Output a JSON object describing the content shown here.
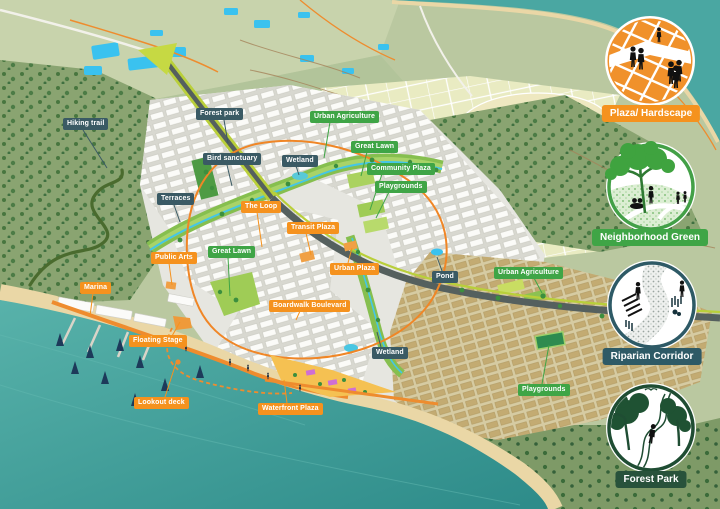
{
  "map_labels": [
    {
      "text": "Hiking trail",
      "category": "nature"
    },
    {
      "text": "Forest park",
      "category": "nature"
    },
    {
      "text": "Bird sanctuary",
      "category": "nature"
    },
    {
      "text": "Terraces",
      "category": "nature"
    },
    {
      "text": "The Loop",
      "category": "urban"
    },
    {
      "text": "Urban Agriculture",
      "category": "green"
    },
    {
      "text": "Great Lawn",
      "category": "green"
    },
    {
      "text": "Wetland",
      "category": "nature"
    },
    {
      "text": "Community Plaza",
      "category": "green"
    },
    {
      "text": "Playgrounds",
      "category": "green"
    },
    {
      "text": "Transit Plaza",
      "category": "urban"
    },
    {
      "text": "Urban Plaza",
      "category": "urban"
    },
    {
      "text": "Great Lawn",
      "category": "green"
    },
    {
      "text": "Public Arts",
      "category": "urban"
    },
    {
      "text": "Marina",
      "category": "urban"
    },
    {
      "text": "Boardwalk Boulevard",
      "category": "urban"
    },
    {
      "text": "Floating Stage",
      "category": "urban"
    },
    {
      "text": "Lookout deck",
      "category": "urban"
    },
    {
      "text": "Waterfront Plaza",
      "category": "urban"
    },
    {
      "text": "Wetland",
      "category": "nature"
    },
    {
      "text": "Pond",
      "category": "nature"
    },
    {
      "text": "Urban Agriculture",
      "category": "green"
    },
    {
      "text": "Playgrounds",
      "category": "green"
    }
  ],
  "legend": {
    "items": [
      {
        "label": "Plaza/ Hardscape",
        "color": "#f5921e",
        "icon": "plaza-hardscape-icon"
      },
      {
        "label": "Neighborhood Green",
        "color": "#3fa546",
        "icon": "neighborhood-green-icon"
      },
      {
        "label": "Riparian Corridor",
        "color": "#2e5a66",
        "icon": "riparian-corridor-icon"
      },
      {
        "label": "Forest Park",
        "color": "#28523b",
        "icon": "forest-park-icon"
      }
    ]
  },
  "tag_colors": {
    "green": "#3fa546",
    "orange": "#f5921e",
    "dark": "#3a5a64"
  },
  "map_colors": {
    "sea": "#3f9e9a",
    "sand": "#ead7a6",
    "hills": "#8aa471",
    "fields": "#e9ebc2",
    "city": "#e6e6e0",
    "axis": "#b9cf3a",
    "loop": "#f08626",
    "stream": "#45c6e6"
  }
}
